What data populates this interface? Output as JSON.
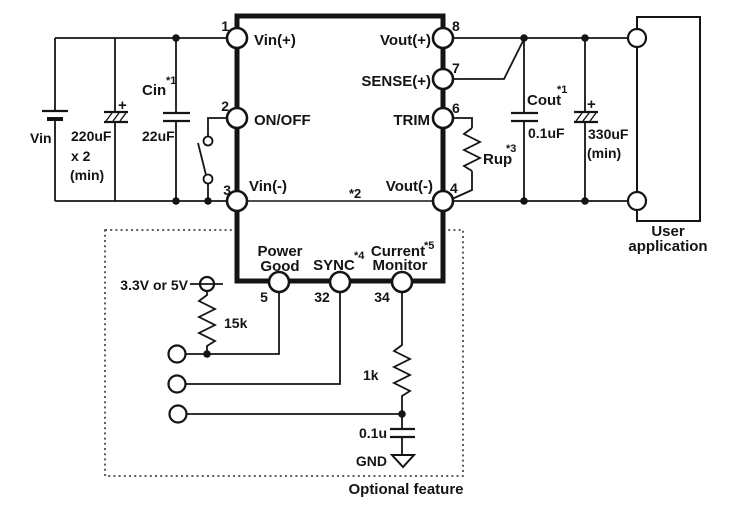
{
  "input": {
    "source_label": "Vin",
    "bulk_cap_plus": "+",
    "bulk_cap_value_1": "220uF",
    "bulk_cap_value_2": "x 2",
    "bulk_cap_value_3": "(min)",
    "cin_name": "Cin",
    "cin_note": "*1",
    "cin_value": "22uF"
  },
  "module": {
    "pin1": {
      "num": "1",
      "label": "Vin(+)"
    },
    "pin2": {
      "num": "2",
      "label": "ON/OFF"
    },
    "pin3": {
      "num": "3",
      "label": "Vin(-)"
    },
    "pin4": {
      "num": "4",
      "label": "Vout(-)"
    },
    "pin5": {
      "num": "5",
      "label_1": "Power",
      "label_2": "Good"
    },
    "pin6": {
      "num": "6",
      "label": "TRIM"
    },
    "pin7": {
      "num": "7",
      "label": "SENSE(+)"
    },
    "pin8": {
      "num": "8",
      "label": "Vout(+)"
    },
    "pin32": {
      "num": "32",
      "label": "SYNC",
      "note": "*4"
    },
    "pin34": {
      "num": "34",
      "label_1": "Current",
      "label_2": "Monitor",
      "note": "*5"
    },
    "internal_note": "*2"
  },
  "output": {
    "cout_name": "Cout",
    "cout_note": "*1",
    "cout_value": "0.1uF",
    "rup_name": "Rup",
    "rup_note": "*3",
    "bulk_cap_plus": "+",
    "bulk_cap_value_1": "330uF",
    "bulk_cap_value_2": "(min)",
    "load_label_1": "User",
    "load_label_2": "application"
  },
  "optional": {
    "supply_label": "3.3V or 5V",
    "pullup_value": "15k",
    "series_resistor_value": "1k",
    "filter_cap_value": "0.1u",
    "ground_label": "GND",
    "caption": "Optional feature"
  },
  "colors": {
    "line": "#141414",
    "background": "#ffffff"
  }
}
